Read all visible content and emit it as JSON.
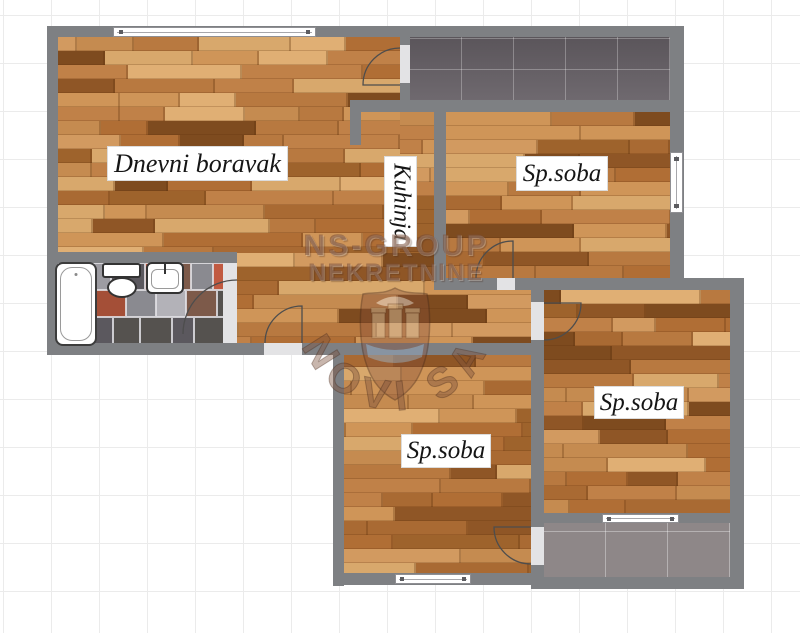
{
  "rooms": {
    "living": {
      "label": "Dnevni boravak"
    },
    "kitchen": {
      "label": "Kuhinja"
    },
    "bedroom_top_right": {
      "label": "Sp.soba"
    },
    "bedroom_bottom_middle": {
      "label": "Sp.soba"
    },
    "bedroom_bottom_right": {
      "label": "Sp.soba"
    }
  },
  "watermark": {
    "line1": "NS-GROUP",
    "line2": "NEKRETNINE",
    "arc": "NOVI SAD"
  },
  "fixtures": {
    "bathtub": "bathtub",
    "toilet": "toilet",
    "sink": "sink"
  },
  "colors": {
    "wall": "#7e8083",
    "wood_base": "#c28349",
    "terrace_dark": "#676167",
    "terrace_light": "#8e8788",
    "bath_tile_red": "#c15a41",
    "watermark_brown": "#744a38",
    "grid_line": "#ebebeb"
  }
}
